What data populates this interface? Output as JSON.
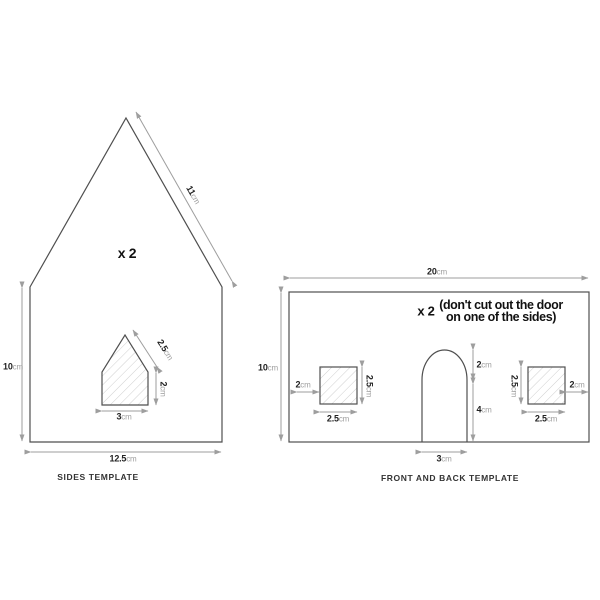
{
  "colors": {
    "background": "#ffffff",
    "outline": "#4f4f4f",
    "dimension": "#9e9e9e",
    "hatch": "#cfcfcf",
    "value_text": "#222222",
    "unit_text": "#9e9e9e"
  },
  "sides_template": {
    "caption": "SIDES TEMPLATE",
    "quantity_label": "x 2",
    "dimensions": {
      "roof": {
        "value": "11",
        "unit": "cm"
      },
      "wall_height": {
        "value": "10",
        "unit": "cm"
      },
      "base_width": {
        "value": "12.5",
        "unit": "cm"
      },
      "window_roof": {
        "value": "2.5",
        "unit": "cm"
      },
      "window_side": {
        "value": "2",
        "unit": "cm"
      },
      "window_base": {
        "value": "3",
        "unit": "cm"
      }
    }
  },
  "front_back_template": {
    "caption": "FRONT AND BACK TEMPLATE",
    "quantity_label": "x 2",
    "note_line1": "(don't cut out the door",
    "note_line2": "on one of the sides)",
    "dimensions": {
      "top_width": {
        "value": "20",
        "unit": "cm"
      },
      "wall_height": {
        "value": "10",
        "unit": "cm"
      },
      "left_window_offset": {
        "value": "2",
        "unit": "cm"
      },
      "left_window_height": {
        "value": "2.5",
        "unit": "cm"
      },
      "left_window_width": {
        "value": "2.5",
        "unit": "cm"
      },
      "door_arch_height": {
        "value": "2",
        "unit": "cm"
      },
      "door_body_height": {
        "value": "4",
        "unit": "cm"
      },
      "door_width": {
        "value": "3",
        "unit": "cm"
      },
      "right_window_height": {
        "value": "2.5",
        "unit": "cm"
      },
      "right_window_offset": {
        "value": "2",
        "unit": "cm"
      },
      "right_window_width": {
        "value": "2.5",
        "unit": "cm"
      }
    }
  }
}
